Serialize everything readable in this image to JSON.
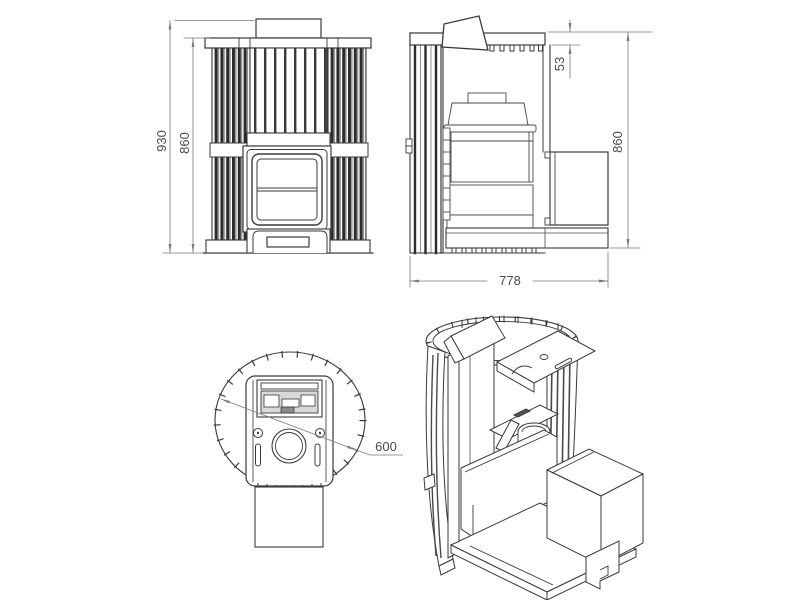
{
  "drawing": {
    "colors": {
      "line": "#3a3a3a",
      "interior_line": "#4a4a4a",
      "dim_line": "#7a7a7a",
      "dim_text": "#4a4a4a",
      "slat_dark": "#2c2c2c",
      "slat_mid": "#8f8f8f",
      "recess_fill": "#d9d9d9",
      "background": "#ffffff"
    },
    "views": {
      "front": {
        "dims": {
          "overall_height": "930",
          "body_height": "860"
        }
      },
      "side": {
        "dims": {
          "top_offset": "53",
          "body_height": "860",
          "depth": "778"
        }
      },
      "top": {
        "dims": {
          "diameter": "600"
        }
      }
    }
  }
}
